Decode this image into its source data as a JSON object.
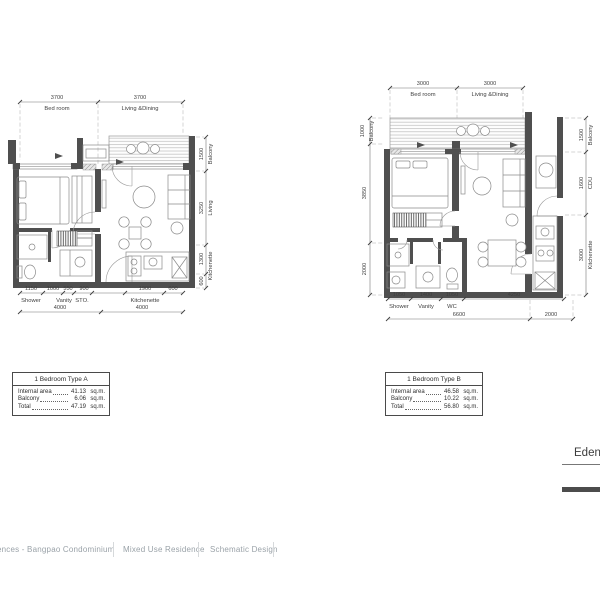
{
  "plan_a": {
    "top": {
      "dims": [
        "3700",
        "3700"
      ],
      "labels": [
        "Bed room",
        "Living &Dining"
      ]
    },
    "right": {
      "dims": [
        "1500",
        "3250",
        "1300",
        "600"
      ],
      "labels": [
        "Balcony",
        "Living",
        "Kitchenette"
      ]
    },
    "bottom": {
      "dims": [
        "1150",
        "1000",
        "550",
        "900",
        "1900",
        "600"
      ],
      "labels": [
        "Shower",
        "Vanity",
        "STO.",
        "Kitchenette"
      ],
      "totals": [
        "4000",
        "4000"
      ]
    },
    "info": {
      "title": "1 Bedroom Type A",
      "rows": [
        {
          "label": "Internal area",
          "value": "41.13",
          "unit": "sq.m."
        },
        {
          "label": "Balcony",
          "value": "6.06",
          "unit": "sq.m."
        },
        {
          "label": "Total",
          "value": "47.19",
          "unit": "sq.m."
        }
      ]
    }
  },
  "plan_b": {
    "top": {
      "dims": [
        "3000",
        "3000"
      ],
      "labels": [
        "Bed room",
        "Living &Dining"
      ]
    },
    "left": {
      "dims": [
        "1000",
        "3850",
        "2000"
      ],
      "labels": [
        "Balcony"
      ]
    },
    "right": {
      "dims": [
        "1500",
        "1600",
        "3000"
      ],
      "labels": [
        "Balcony",
        "CDU",
        "Kitchenette"
      ]
    },
    "bottom": {
      "dims": [
        "1050",
        "1400",
        "1050",
        "4250"
      ],
      "labels": [
        "Shower",
        "Vanity",
        "WC"
      ],
      "totals": [
        "6600",
        "2000"
      ]
    },
    "info": {
      "title": "1 Bedroom Type B",
      "rows": [
        {
          "label": "Internal area",
          "value": "46.58",
          "unit": "sq.m."
        },
        {
          "label": "Balcony",
          "value": "10.22",
          "unit": "sq.m."
        },
        {
          "label": "Total",
          "value": "56.80",
          "unit": "sq.m."
        }
      ]
    }
  },
  "title_block": {
    "project": "Eden"
  },
  "footer": {
    "items": [
      "ences - Bangpao Condominium",
      "Mixed Use Residence",
      "Schematic Design"
    ]
  }
}
